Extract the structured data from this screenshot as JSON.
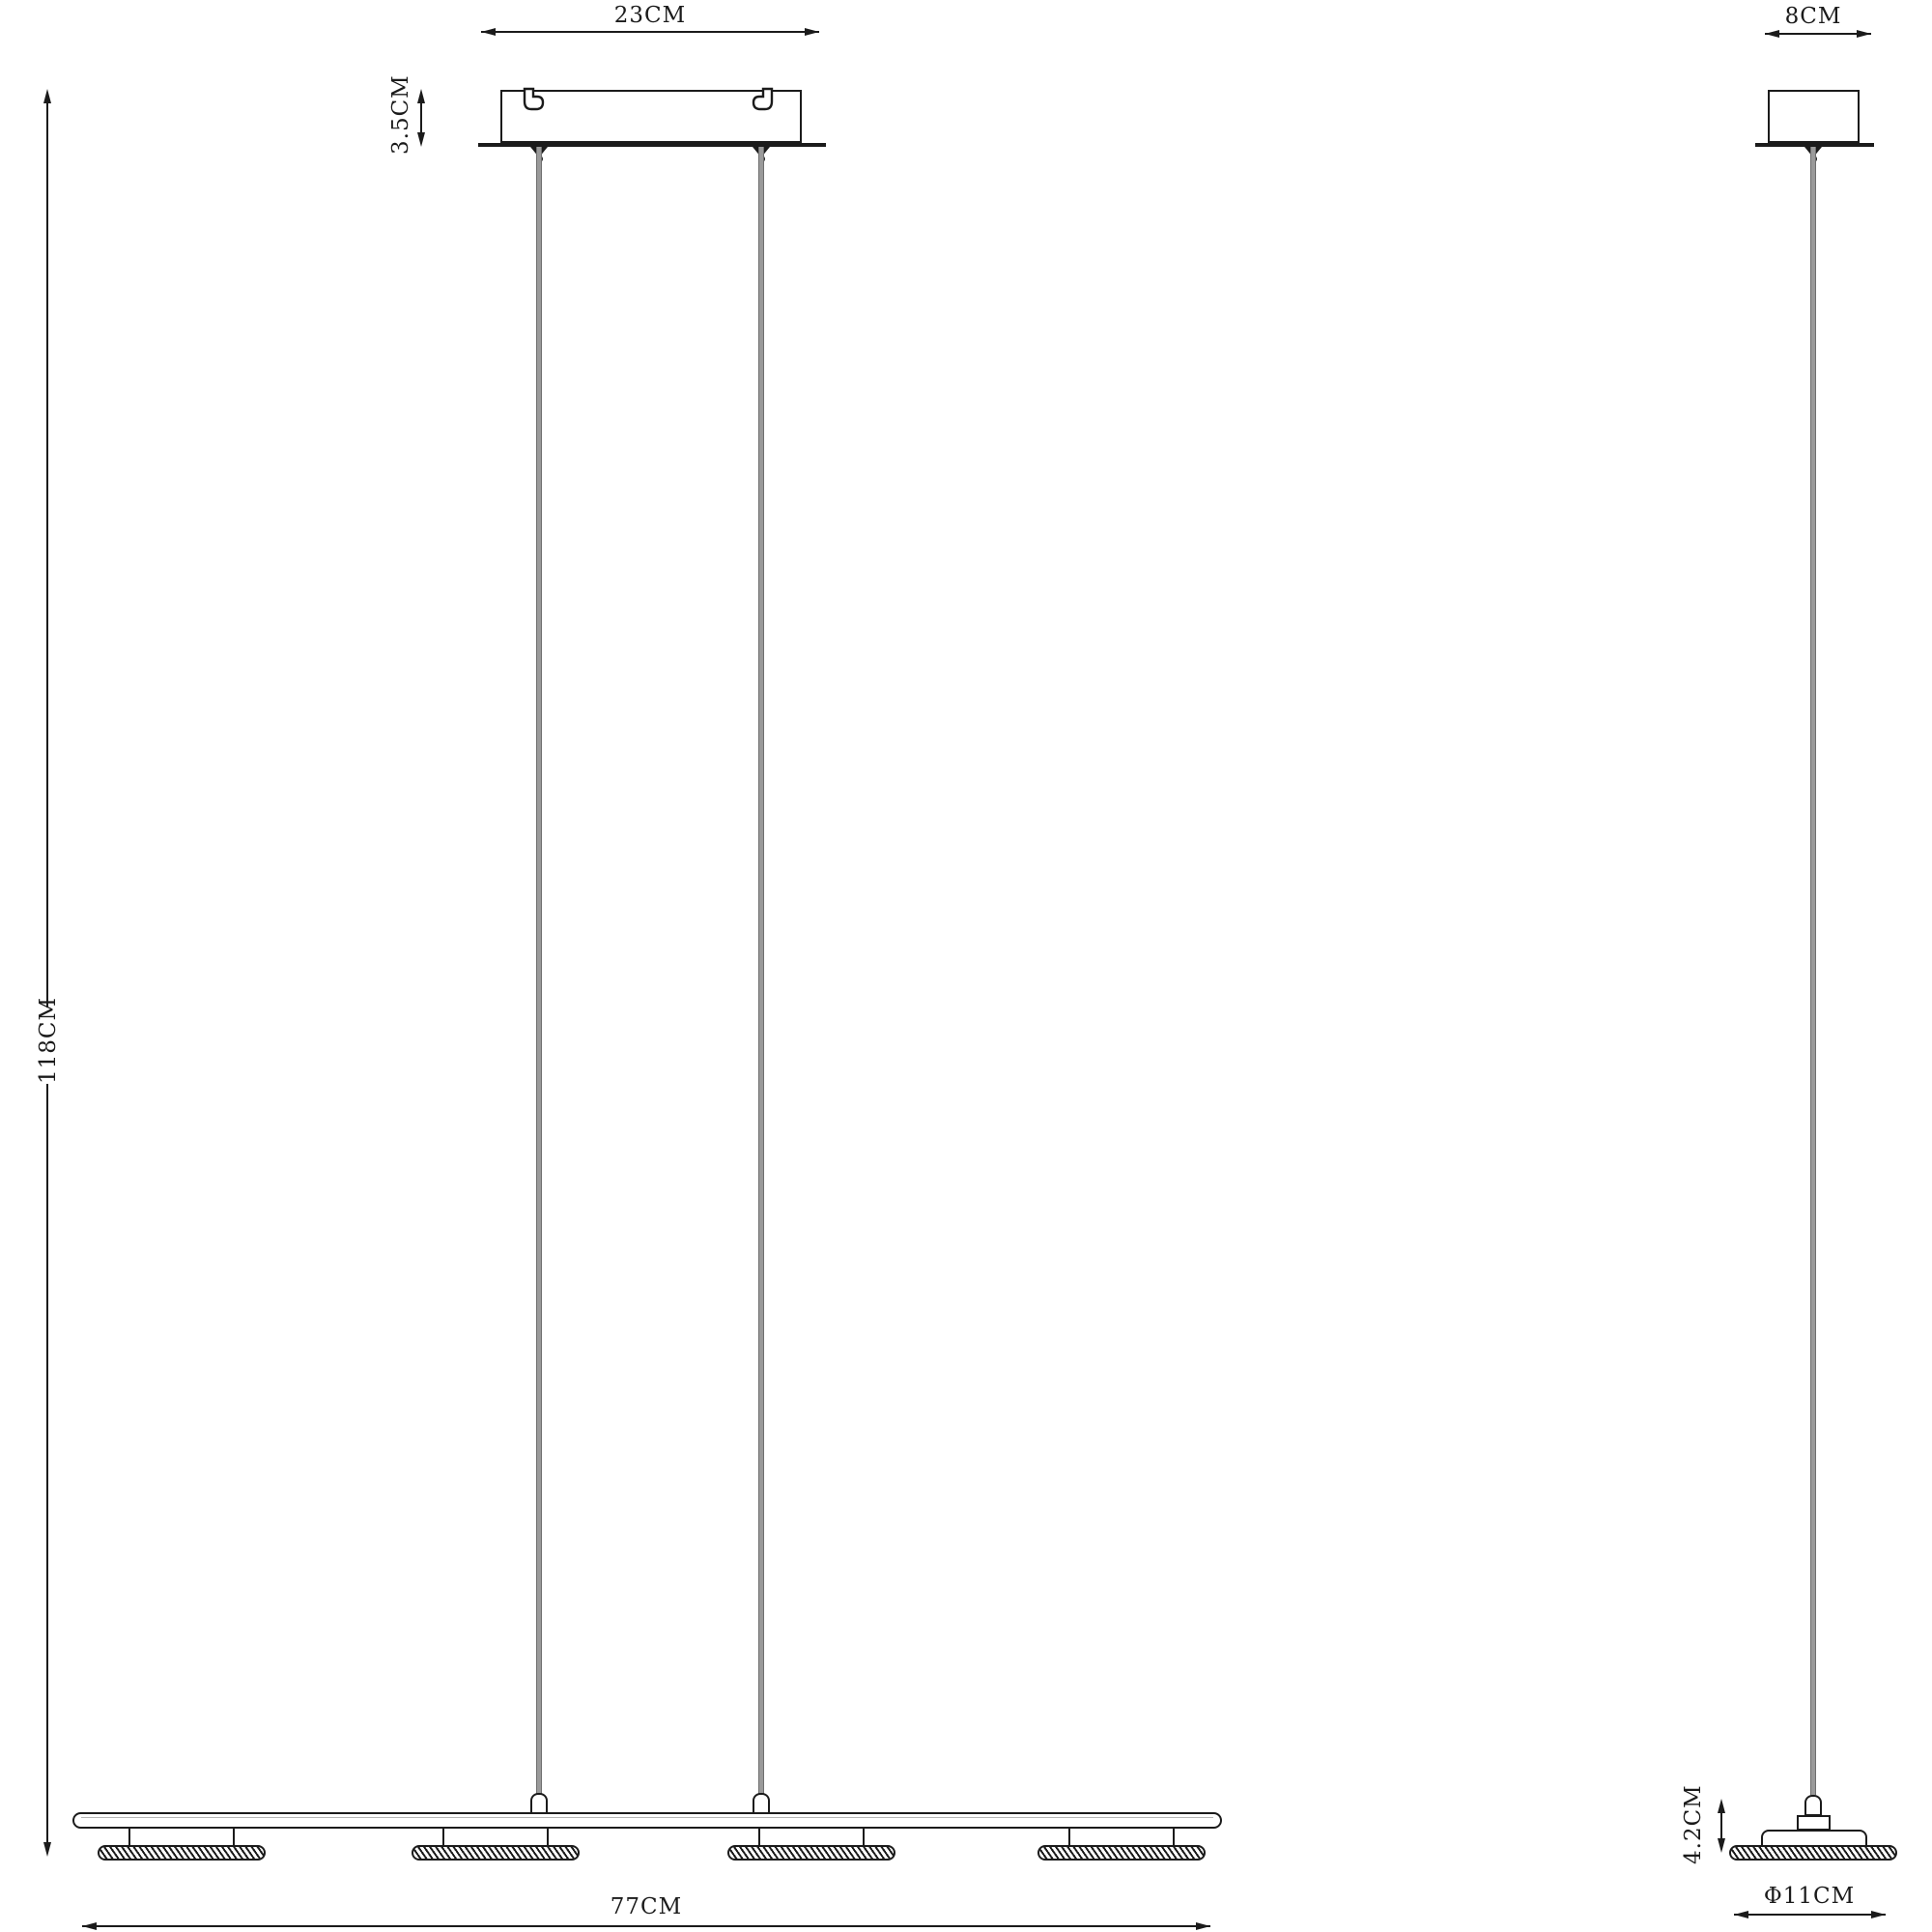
{
  "diagram": {
    "type": "pendant-lamp-dimension-drawing",
    "front_view": {
      "dim_canopy_width": "23CM",
      "dim_canopy_height": "3.5CM",
      "dim_overall_height": "118CM",
      "dim_bar_length": "77CM",
      "shade_count": 4
    },
    "side_view": {
      "dim_canopy_width": "8CM",
      "dim_head_height": "4.2CM",
      "dim_shade_diameter": "Φ11CM"
    },
    "colors": {
      "line": "#1b1b1b",
      "cable": "#9a9a9a",
      "background": "#ffffff"
    }
  }
}
